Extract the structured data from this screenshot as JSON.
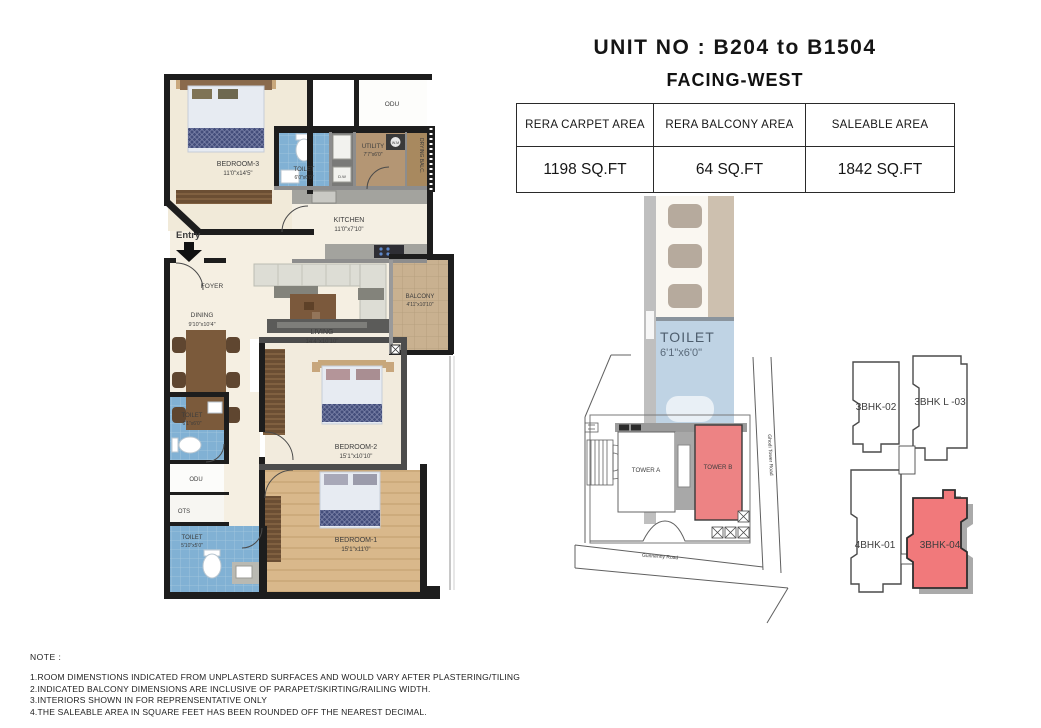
{
  "header": {
    "unit_no": "UNIT NO : B204 to B1504",
    "facing": "FACING-WEST"
  },
  "area_table": {
    "columns": [
      "RERA CARPET AREA",
      "RERA BALCONY AREA",
      "SALEABLE AREA"
    ],
    "values": [
      "1198 SQ.FT",
      "64 SQ.FT",
      "1842 SQ.FT"
    ]
  },
  "floorplan": {
    "entry_label": "Entry",
    "rooms": {
      "bedroom3": {
        "name": "BEDROOM-3",
        "dims": "11'0\"x14'5\""
      },
      "odu_top": {
        "name": "ODU"
      },
      "toilet_top": {
        "name": "TOILET",
        "dims": "6'0\"x6'0\""
      },
      "utility": {
        "name": "UTILITY",
        "dims": "7'7\"x6'0\""
      },
      "drying_balcony": {
        "name": "DRYING BALC."
      },
      "kitchen": {
        "name": "KITCHEN",
        "dims": "11'0\"x7'10\""
      },
      "foyer": {
        "name": "FOYER"
      },
      "dining": {
        "name": "DINING",
        "dims": "9'10\"x10'4\""
      },
      "living": {
        "name": "LIVING",
        "dims": "14'4\"x10'10\""
      },
      "balcony": {
        "name": "BALCONY",
        "dims": "4'11\"x10'10\""
      },
      "toilet_mid": {
        "name": "TOILET",
        "dims": "6'1\"x6'0\""
      },
      "bedroom2": {
        "name": "BEDROOM-2",
        "dims": "15'1\"x10'10\""
      },
      "odu_mid": {
        "name": "ODU"
      },
      "ots": {
        "name": "OTS"
      },
      "toilet_bottom": {
        "name": "TOILET",
        "dims": "5'10\"x5'0\""
      },
      "bedroom1": {
        "name": "BEDROOM-1",
        "dims": "15'1\"x11'0\""
      }
    },
    "appliances": {
      "washing_machine": "W.M",
      "dish_washer": "D.W"
    }
  },
  "ghost_overlay": {
    "toilet_name": "TOILET",
    "toilet_dims": "6'1\"x6'0\"",
    "odu": "ODU"
  },
  "site_plan": {
    "tower_a": "TOWER A",
    "tower_b": "TOWER B",
    "road_right": "Ghodi Tower Road",
    "road_bottom": "Gunnenny Road"
  },
  "key_plan": {
    "units": [
      {
        "id": "3bhk-02",
        "label": "3BHK-02",
        "highlighted": false
      },
      {
        "id": "3bhk-l-03",
        "label": "3BHK L -03",
        "highlighted": false
      },
      {
        "id": "4bhk-01",
        "label": "4BHK-01",
        "highlighted": false
      },
      {
        "id": "3bhk-04",
        "label": "3BHK-04",
        "highlighted": true
      }
    ]
  },
  "notes": {
    "title": "NOTE :",
    "items": [
      "1.ROOM DIMENSTIONS INDICATED FROM UNPLASTERD SURFACES AND WOULD VARY AFTER PLASTERING/TILING",
      "2.INDICATED BALCONY DIMENSIONS ARE INCLUSIVE OF PARAPET/SKIRTING/RAILING WIDTH.",
      "3.INTERIORS SHOWN IN FOR REPRENSENTATIVE ONLY",
      "4.THE SALEABLE AREA IN SQUARE FEET HAS BEEN ROUNDED OFF THE NEAREST DECIMAL."
    ]
  },
  "colors": {
    "highlight_red": "#f1797b",
    "tower_b_red": "#ed8384",
    "toilet_blue": "#81b1d4",
    "floor_beige": "#f2ebdd",
    "utility_brown": "#b49674",
    "wall_black": "#1d1d1d"
  }
}
